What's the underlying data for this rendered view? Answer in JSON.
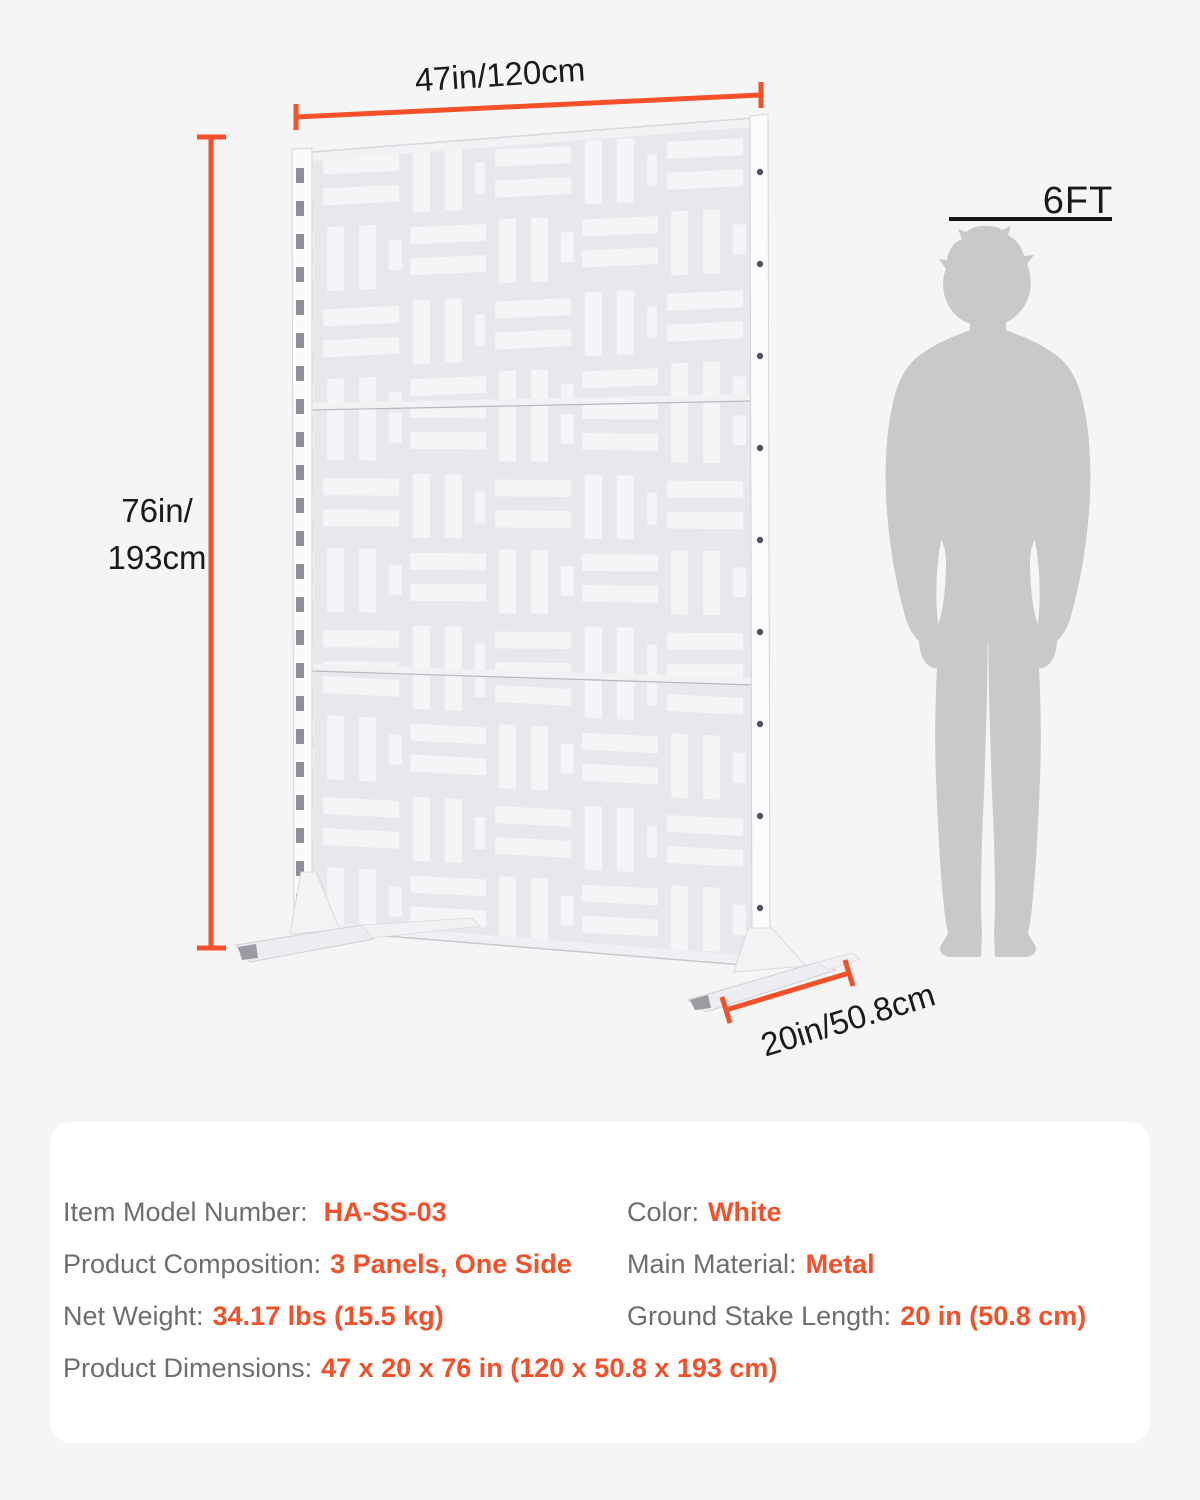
{
  "colors": {
    "accent": "#f4512b",
    "background": "#f5f5f6",
    "panel": "#e7e7ec",
    "silhouette": "#c9c9c9",
    "spec_label": "#6e6e6e",
    "spec_value": "#f4512b"
  },
  "illustration": {
    "screen_icon": "privacy-screen-3-panel-weave",
    "width_label": "47in/120cm",
    "height_label": [
      "76in/",
      "193cm"
    ],
    "depth_label": "20in/50.8cm",
    "person": {
      "icon": "man-silhouette",
      "height_label": "6FT"
    }
  },
  "spec_card": {
    "rows": [
      {
        "label": "Item Model Number:",
        "value": "HA-SS-03"
      },
      {
        "label": "Color:",
        "value": "White"
      },
      {
        "label": "Product Composition:",
        "value": "3 Panels, One Side"
      },
      {
        "label": "Main Material:",
        "value": "Metal"
      },
      {
        "label": "Net Weight:",
        "value": "34.17 lbs (15.5 kg)"
      },
      {
        "label": "Ground Stake Length:",
        "value": "20 in (50.8 cm)"
      },
      {
        "label": "Product Dimensions:",
        "value": "47 x 20 x 76 in (120 x 50.8 x 193 cm)"
      }
    ]
  }
}
